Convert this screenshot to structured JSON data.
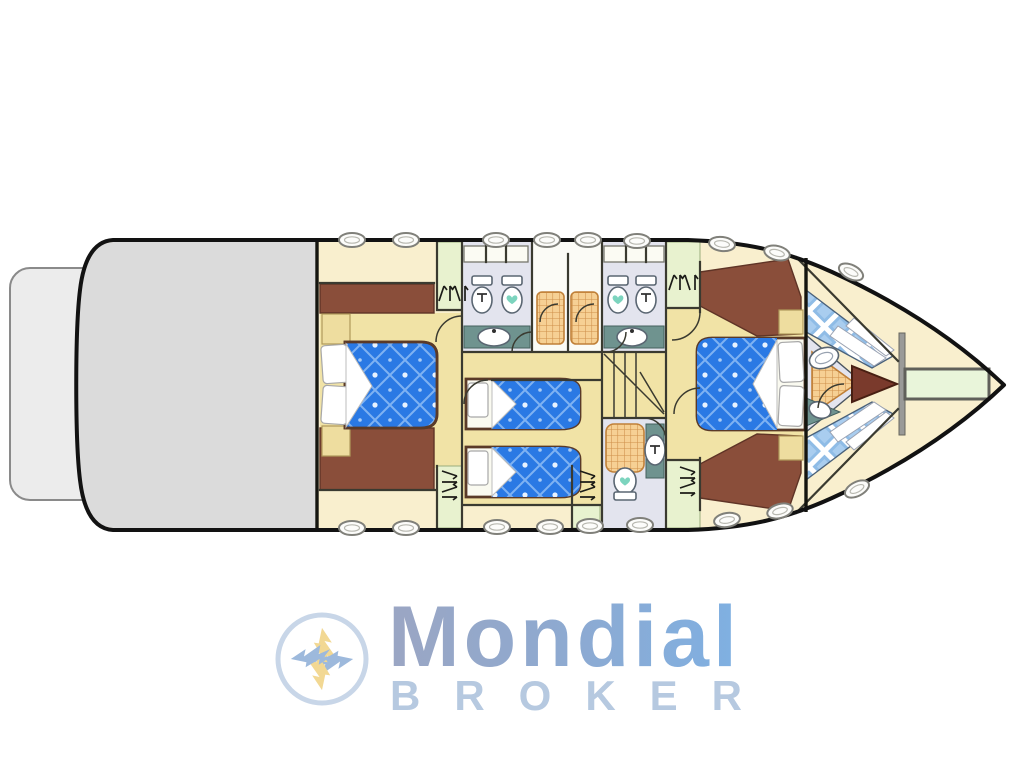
{
  "meta": {
    "title": "Yacht lower-deck accommodation floor plan"
  },
  "logo": {
    "brand": "Mondial",
    "sub_brand": "BROKER",
    "emblem": "pinwheel-lightning-badge"
  },
  "palette": {
    "page_bg": "#ffffff",
    "hull_outline": "#121212",
    "deck_cream": "#f9efce",
    "aft_deck_gray": "#dbdbdb",
    "platform_gray": "#ececec",
    "floor_tan": "#f1e3a6",
    "furniture_brown": "#8a4e3a",
    "bed_blue": "#2a79e4",
    "bath_floor_lavender": "#e3e4ee",
    "wardrobe_green": "#e8f2cf",
    "shower_orange": "#f6d094",
    "counter_teal": "#6f938f",
    "vberth_check_blue": "#8fbce6",
    "anchor_locker_green": "#e9f5da",
    "heart_teal": "#7cd4be",
    "logo_text_blue": "#87b0e0",
    "logo_sub_blue": "#b6c9e0",
    "emblem_yellow": "#f2d893",
    "emblem_blue": "#9db9dc"
  },
  "plan": {
    "orientation": "bow-right",
    "decks": [
      "swim-platform",
      "aft-deck",
      "accommodation-deck",
      "bow-deck"
    ],
    "rooms": [
      {
        "name": "master-cabin",
        "features": [
          "double-bed",
          "wardrobe",
          "nightstands",
          "dressers"
        ]
      },
      {
        "name": "guest-bathroom-port",
        "features": [
          "bidet",
          "toilet",
          "sink",
          "shower-stall"
        ]
      },
      {
        "name": "guest-bathroom-starboard",
        "features": [
          "toilet",
          "bidet",
          "sink",
          "shower-stall"
        ]
      },
      {
        "name": "twin-cabin",
        "features": [
          "single-bed",
          "single-bed",
          "wardrobe",
          "wardrobe"
        ]
      },
      {
        "name": "companionway-stairs",
        "features": [
          "winder-steps"
        ]
      },
      {
        "name": "day-head",
        "features": [
          "shower",
          "sink",
          "toilet"
        ]
      },
      {
        "name": "vip-cabin",
        "features": [
          "double-bed",
          "wardrobe",
          "nightstands"
        ]
      },
      {
        "name": "crew-bow-cabin",
        "features": [
          "v-berth",
          "v-berth",
          "toilet",
          "sink"
        ]
      },
      {
        "name": "anchor-locker",
        "features": []
      }
    ],
    "deck_fittings": {
      "top_cleats": 9,
      "bottom_cleats": 9
    }
  }
}
